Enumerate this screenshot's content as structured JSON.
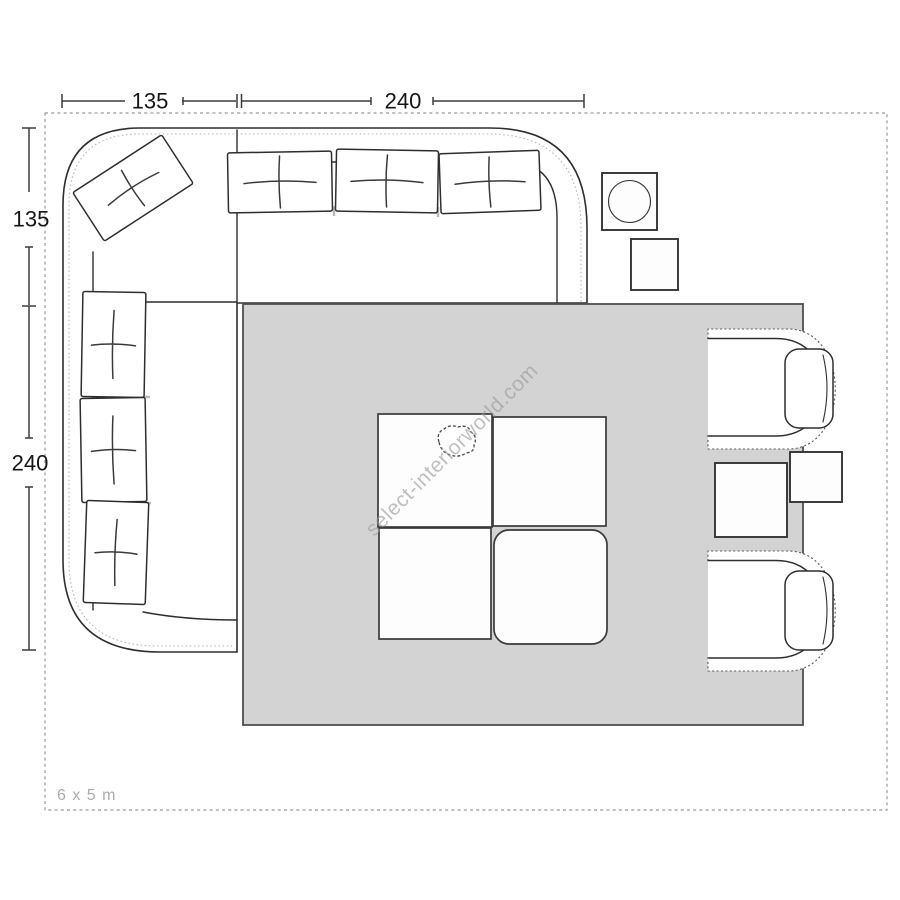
{
  "floor_plan": {
    "room_size_label": "6 x 5 m",
    "watermark_text": "select-interiorworld.com",
    "dimensions_top": [
      {
        "label": "135"
      },
      {
        "label": "240"
      }
    ],
    "dimensions_left": [
      {
        "label": "135"
      },
      {
        "label": "240"
      }
    ],
    "colors": {
      "rug": "#d3d3d3",
      "outline": "#2f2f2f",
      "dimension_line": "#3d3d3d",
      "room_border": "#9a9a9a",
      "watermark": "#9a9a9a",
      "room_label": "#ababab"
    },
    "furniture": [
      "corner-sofa",
      "rug",
      "modular-coffee-table",
      "armchair-top",
      "armchair-bottom",
      "side-table-between-chairs",
      "side-table-right",
      "side-table-top",
      "lamp-side-table"
    ]
  }
}
